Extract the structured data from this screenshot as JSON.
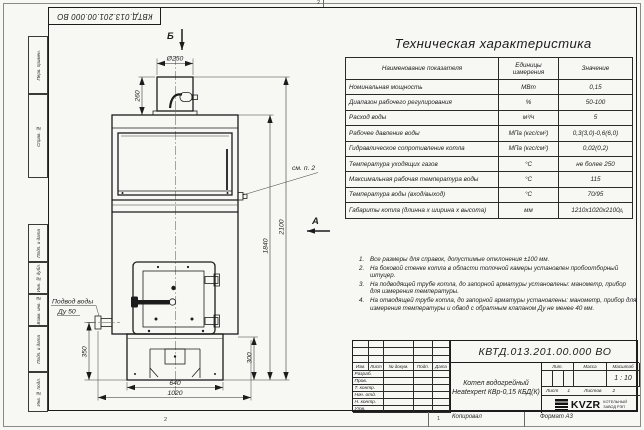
{
  "sheet": {
    "stamp_rotated": "КВТД.013.201.00.000 ВО",
    "zone_top": "2",
    "zone_bottom": "2",
    "zone_bottom_right": "1",
    "zone_right": "А"
  },
  "frame_left": {
    "labels": [
      "Перв. примен.",
      "Справ. №",
      "Подп. и дата",
      "Инв. № дубл.",
      "Взам. инв. №",
      "Подп. и дата",
      "Инв. № подл."
    ]
  },
  "drawing": {
    "view_b": "Б",
    "view_a": "А",
    "callout_note2": "см. п. 2",
    "inlet_label1": "Подвод воды",
    "inlet_label2": "Ду 50",
    "dims": {
      "chimney_dia": "Ø250",
      "chimney_h": "260",
      "total_h": "2100",
      "body_h": "1840",
      "right_h": "300",
      "inlet_h": "350",
      "base_w": "640",
      "total_w": "1020"
    }
  },
  "spec_table": {
    "title": "Техническая характеристика",
    "headers": [
      "Наименование показателя",
      "Единицы измерения",
      "Значение"
    ],
    "rows": [
      [
        "Номинальная мощность",
        "МВт",
        "0,15"
      ],
      [
        "Диапазон рабочего регулирования",
        "%",
        "50-100"
      ],
      [
        "Расход воды",
        "м³/ч",
        "5"
      ],
      [
        "Рабочее давление воды",
        "МПа (кгс/см²)",
        "0,3(3,0)-0,6(6,0)"
      ],
      [
        "Гидравлическое сопротивление котла",
        "МПа (кгс/см²)",
        "0,02(0,2)"
      ],
      [
        "Температура уходящих газов",
        "°С",
        "не более 250"
      ],
      [
        "Максимальная рабочая температура воды",
        "°С",
        "115"
      ],
      [
        "Температура воды (вход/выход)",
        "°С",
        "70/95"
      ],
      [
        "Габариты котла (длинна х ширина х высота)",
        "мм",
        "1210х1020х2100"
      ]
    ]
  },
  "notes": [
    {
      "n": "1.",
      "text": "Все размеры для справок, допустимые отклонения ±100 мм."
    },
    {
      "n": "2.",
      "text": "На боковой стенке котла в области топочной камеры установлен пробоотборный штуцер."
    },
    {
      "n": "3.",
      "text": "На подводящей трубе котла, до запорной арматуры установлены: манометр, прибор для измерения температуры."
    },
    {
      "n": "4.",
      "text": "На отводящей трубе котла, до запорной арматуры установлены: манометр, прибор для измерения температуры и обвод с обратным клапаном Ду не менее 40 мм."
    }
  ],
  "title_block": {
    "doc_number": "КВТД.013.201.00.000 ВО",
    "header_cols": [
      "Изм.",
      "Лист",
      "№ докум.",
      "Подп.",
      "Дата"
    ],
    "row_labels": [
      "Разраб.",
      "Пров.",
      "Т. контр.",
      "Нач. отд.",
      "Н. контр.",
      "Утв."
    ],
    "product_line1": "Котел водогрейный",
    "product_line2": "Heatexpert КВр-0,15 КБД(К)",
    "lit_label": "Лит.",
    "mass_label": "Масса",
    "scale_label": "Масштаб",
    "scale_value": "1 : 10",
    "sheet_label": "Лист",
    "sheet_value": "1",
    "sheets_label": "Листов",
    "sheets_value": "2",
    "logo_text": "KVZR",
    "logo_sub1": "КОТЕЛЬНЫЙ",
    "logo_sub2": "ЗАВОД РЭП",
    "copied_label": "Копировал",
    "format_label": "Формат А3"
  }
}
